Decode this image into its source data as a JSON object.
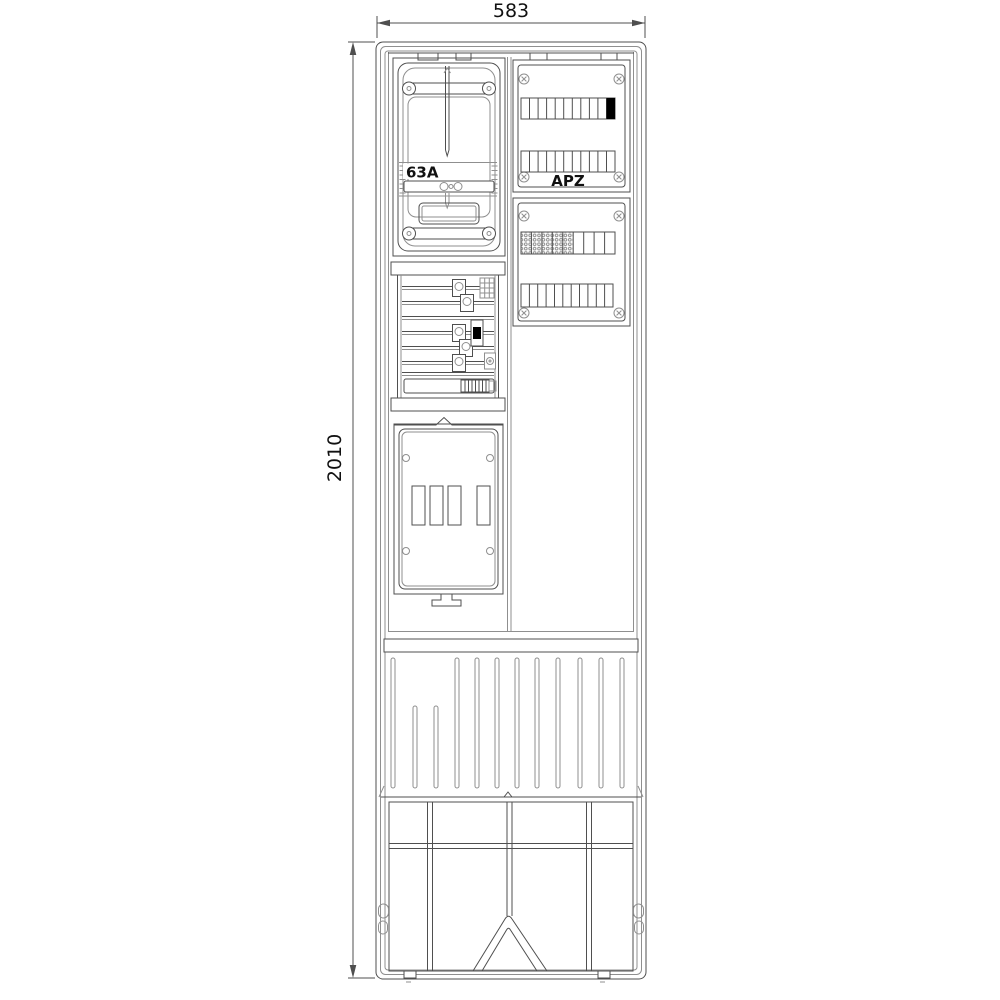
{
  "drawing": {
    "title": "Meter pillar front view technical drawing",
    "dimension_width_label": "583",
    "dimension_height_label": "2010",
    "meter_panel": {
      "rating_label": "63A"
    },
    "apz_panel": {
      "label": "APZ",
      "module_rows": 2,
      "modules_per_row": 11,
      "filled_modules": 1
    },
    "terminal_panel": {
      "module_rows": 2,
      "terminal_blocks": 5
    }
  },
  "colors": {
    "background": "#ffffff",
    "line": "#4f4f4f",
    "line_light": "#8f8f8f",
    "text": "#111111",
    "filled_module": "#000000"
  }
}
